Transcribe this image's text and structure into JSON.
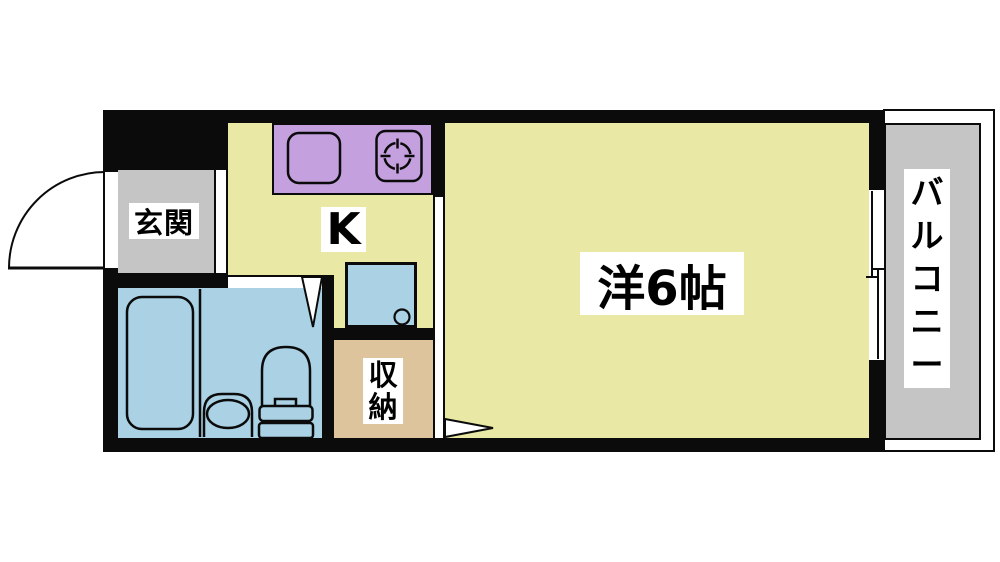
{
  "page": {
    "type": "apartment-floor-plan-1K",
    "background": "#ffffff"
  },
  "rooms": {
    "entrance": {
      "label": "玄関"
    },
    "kitchen": {
      "label": "K"
    },
    "main_room": {
      "label": "洋6帖"
    },
    "storage": {
      "label": "収納",
      "chars": [
        "収",
        "納"
      ]
    },
    "balcony": {
      "label": "バルコニー",
      "chars": [
        "バ",
        "ル",
        "コ",
        "ニ",
        "ー"
      ]
    }
  },
  "fixtures": {
    "entrance_door": "swing-door-arc",
    "bathroom_door": "door-swing-wedge",
    "main_room_door": "door-swing-wedge",
    "bathtub": "bathtub",
    "washbasin": "washbasin",
    "toilet": "toilet",
    "kitchen_sink": "kitchen-sink",
    "stove": "gas-burner",
    "washer_pan": "washing-machine-pan",
    "window": "sliding-window"
  },
  "colors": {
    "wall": "#0b0b0b",
    "floor_yellow": "#e9e9a5",
    "counter_purple": "#c5a0de",
    "water_blue": "#aad2e4",
    "gray": "#c5c5c5",
    "storage_tan": "#ddc49c"
  }
}
